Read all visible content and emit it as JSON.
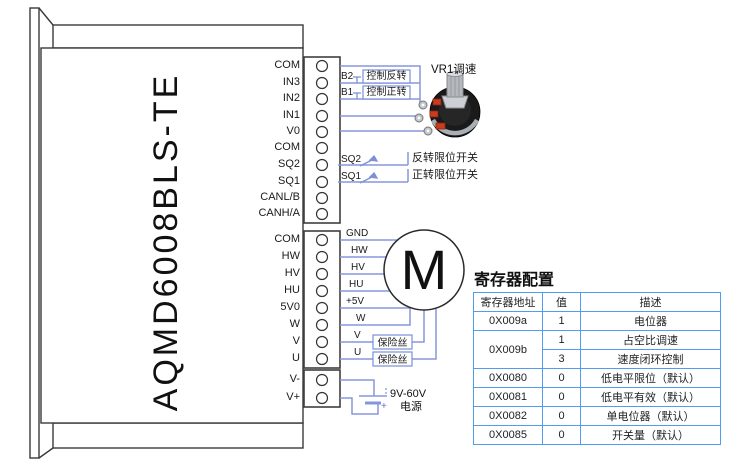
{
  "device": {
    "model": "AQMD6008BLS-TE"
  },
  "block1": {
    "pins": [
      "COM",
      "IN3",
      "IN2",
      "IN1",
      "V0",
      "COM",
      "SQ2",
      "SQ1",
      "CANL/B",
      "CANH/A"
    ]
  },
  "block2": {
    "pins": [
      "COM",
      "HW",
      "HV",
      "HU",
      "5V0",
      "W",
      "V",
      "U"
    ],
    "wire_labels": [
      "GND",
      "HW",
      "HV",
      "HU",
      "+5V",
      "W",
      "V",
      "U"
    ]
  },
  "block3": {
    "pins": [
      "V-",
      "V+"
    ]
  },
  "controls": {
    "b2": {
      "label": "B2",
      "action": "控制反转"
    },
    "b1": {
      "label": "B1",
      "action": "控制正转"
    },
    "sq2": {
      "label": "SQ2",
      "action": "反转限位开关"
    },
    "sq1": {
      "label": "SQ1",
      "action": "正转限位开关"
    },
    "vr1": {
      "label": "VR1调速"
    }
  },
  "motor": {
    "symbol": "M"
  },
  "fuse": {
    "label": "保险丝"
  },
  "power": {
    "range": "9V-60V",
    "label": "电源",
    "polarity": "+"
  },
  "registers": {
    "title": "寄存器配置",
    "headers": [
      "寄存器地址",
      "值",
      "描述"
    ],
    "rows": [
      {
        "addr": "0X009a",
        "value": "1",
        "desc": "电位器"
      },
      {
        "addr": "0X009b",
        "value": "1",
        "desc": "占空比调速"
      },
      {
        "addr": "",
        "value": "3",
        "desc": "速度闭环控制"
      },
      {
        "addr": "0X0080",
        "value": "0",
        "desc": "低电平限位（默认）"
      },
      {
        "addr": "0X0081",
        "value": "0",
        "desc": "低电平有效（默认）"
      },
      {
        "addr": "0X0082",
        "value": "0",
        "desc": "单电位器（默认）"
      },
      {
        "addr": "0X0085",
        "value": "0",
        "desc": "开关量（默认）"
      }
    ]
  },
  "colors": {
    "wire": "#8596dd",
    "box_border": "#7c90d8",
    "table_border": "#4f9cf0"
  }
}
